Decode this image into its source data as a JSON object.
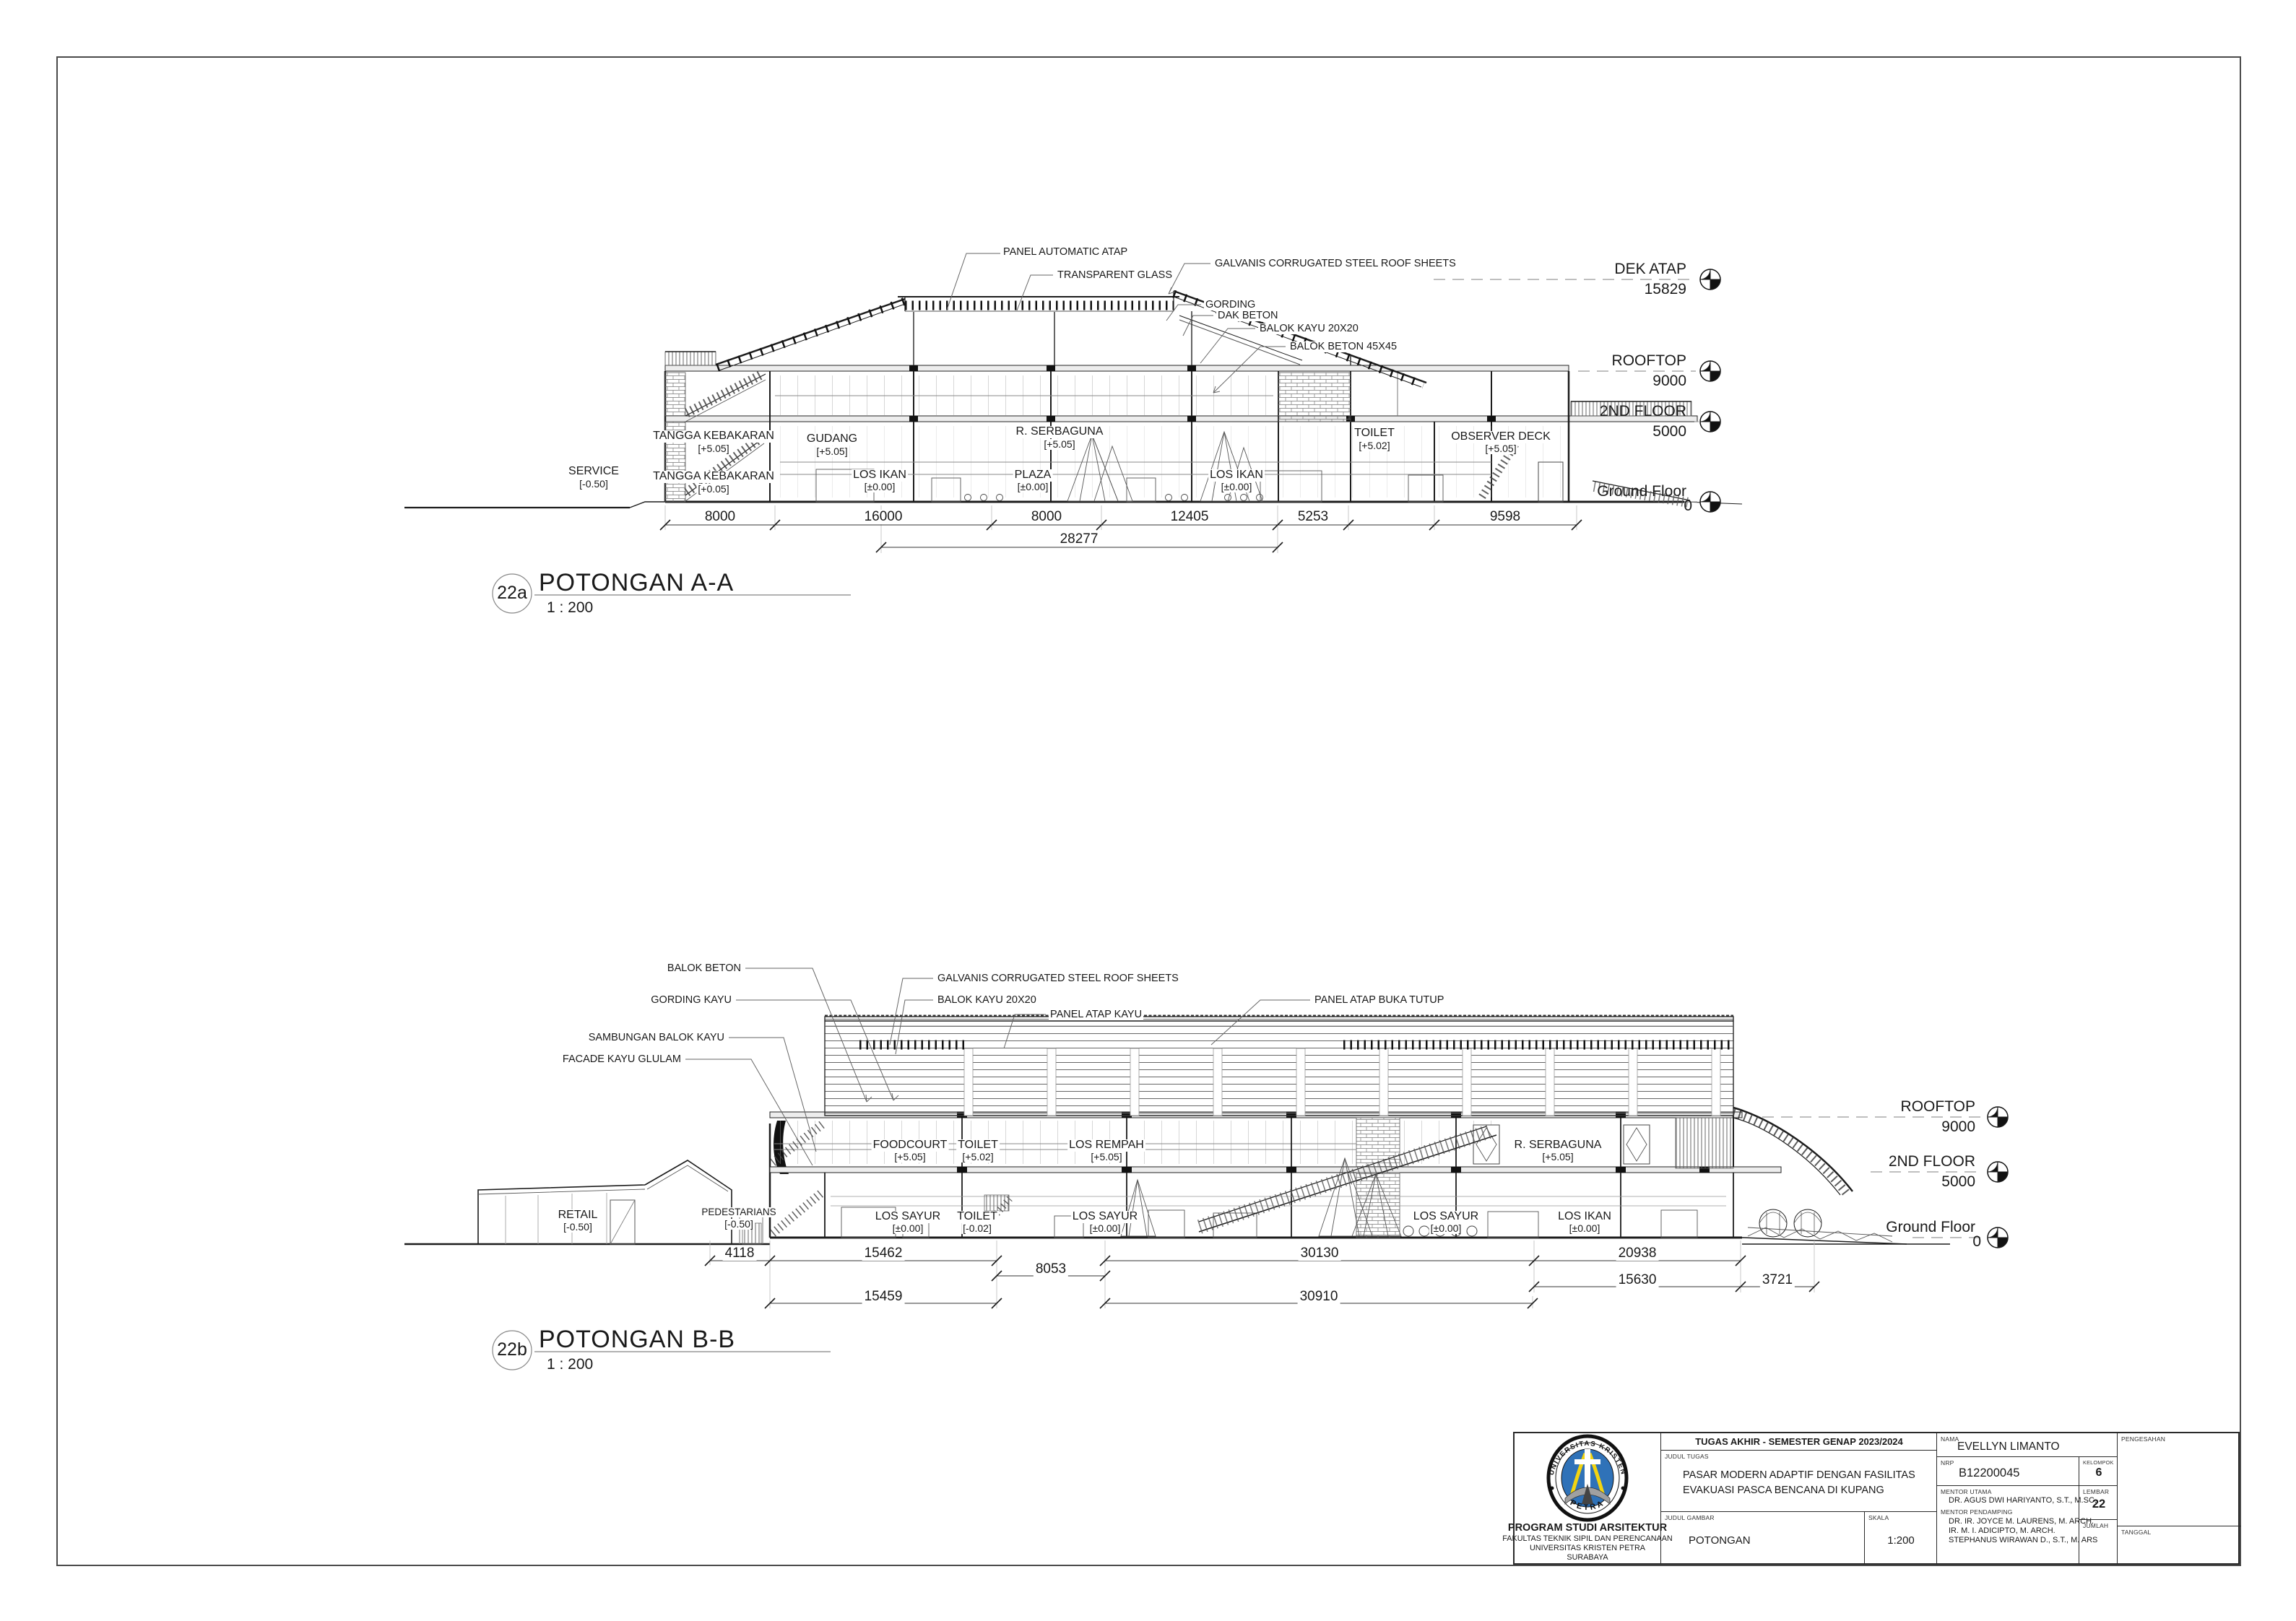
{
  "potongan_aa": {
    "marker_id": "22a",
    "title": "POTONGAN A-A",
    "scale": "1 : 200",
    "callouts": [
      "PANEL AUTOMATIC ATAP",
      "TRANSPARENT GLASS",
      "GALVANIS CORRUGATED STEEL ROOF SHEETS",
      "GORDING",
      "DAK BETON",
      "BALOK KAYU 20X20",
      "BALOK BETON 45X45"
    ],
    "rooms": [
      {
        "name": "TANGGA KEBAKARAN",
        "level": "[+5.05]"
      },
      {
        "name": "GUDANG",
        "level": "[+5.05]"
      },
      {
        "name": "R. SERBAGUNA",
        "level": "[+5.05]"
      },
      {
        "name": "TOILET",
        "level": "[+5.02]"
      },
      {
        "name": "OBSERVER DECK",
        "level": "[+5.05]"
      },
      {
        "name": "TANGGA KEBAKARAN",
        "level": "[+0.05]"
      },
      {
        "name": "LOS IKAN",
        "level": "[±0.00]"
      },
      {
        "name": "PLAZA",
        "level": "[±0.00]"
      },
      {
        "name": "LOS IKAN",
        "level": "[±0.00]"
      },
      {
        "name": "SERVICE",
        "level": "[-0.50]"
      }
    ],
    "levels": [
      {
        "name": "DEK ATAP",
        "value": "15829"
      },
      {
        "name": "ROOFTOP",
        "value": "9000"
      },
      {
        "name": "2ND FLOOR",
        "value": "5000"
      },
      {
        "name": "Ground Floor",
        "value": "0"
      }
    ],
    "dims": [
      "8000",
      "16000",
      "8000",
      "12405",
      "5253",
      "9598"
    ],
    "dim_total": "28277"
  },
  "potongan_bb": {
    "marker_id": "22b",
    "title": "POTONGAN B-B",
    "scale": "1 : 200",
    "callouts": [
      "BALOK BETON",
      "GALVANIS CORRUGATED STEEL ROOF SHEETS",
      "GORDING KAYU",
      "BALOK KAYU 20X20",
      "PANEL ATAP KAYU",
      "PANEL ATAP BUKA TUTUP",
      "SAMBUNGAN BALOK KAYU",
      "FACADE KAYU GLULAM"
    ],
    "rooms_upper": [
      {
        "name": "FOODCOURT",
        "level": "[+5.05]"
      },
      {
        "name": "TOILET",
        "level": "[+5.02]"
      },
      {
        "name": "LOS REMPAH",
        "level": "[+5.05]"
      },
      {
        "name": "R. SERBAGUNA",
        "level": "[+5.05]"
      }
    ],
    "rooms_ground": [
      {
        "name": "RETAIL",
        "level": "[-0.50]"
      },
      {
        "name": "PEDESTARIANS",
        "level": "[-0.50]"
      },
      {
        "name": "LOS SAYUR",
        "level": "[±0.00]"
      },
      {
        "name": "TOILET",
        "level": "[-0.02]"
      },
      {
        "name": "LOS SAYUR",
        "level": "[±0.00]"
      },
      {
        "name": "LOS SAYUR",
        "level": "[±0.00]"
      },
      {
        "name": "LOS IKAN",
        "level": "[±0.00]"
      }
    ],
    "levels": [
      {
        "name": "ROOFTOP",
        "value": "9000"
      },
      {
        "name": "2ND FLOOR",
        "value": "5000"
      },
      {
        "name": "Ground Floor",
        "value": "0"
      }
    ],
    "dims_row1": [
      "4118",
      "15462",
      "8053",
      "30130",
      "20938"
    ],
    "dims_row2": [
      "15459",
      "30910",
      "15630",
      "3721"
    ]
  },
  "title_block": {
    "header": "TUGAS AKHIR - SEMESTER GENAP 2023/2024",
    "labels": {
      "judul_tugas": "JUDUL TUGAS",
      "judul_gambar": "JUDUL GAMBAR",
      "skala": "SKALA",
      "nama": "NAMA",
      "nrp": "NRP",
      "kelompok": "KELOMPOK",
      "mentor_utama": "MENTOR UTAMA",
      "mentor_pendamping": "MENTOR PENDAMPING",
      "lembar": "LEMBAR",
      "jumlah": "JUMLAH",
      "pengesahan": "PENGESAHAN",
      "tanggal": "TANGGAL"
    },
    "judul_tugas_line1": "PASAR MODERN ADAPTIF DENGAN FASILITAS",
    "judul_tugas_line2": "EVAKUASI PASCA BENCANA DI KUPANG",
    "judul_gambar": "POTONGAN",
    "skala": "1:200",
    "nama": "EVELLYN LIMANTO",
    "nrp": "B12200045",
    "kelompok": "6",
    "mentor_utama": "DR. AGUS DWI HARIYANTO, S.T., M.SC.",
    "mentor_pendamping_lines": [
      "DR. IR. JOYCE M. LAURENS, M. ARCH.",
      "IR. M. I. ADICIPTO, M. ARCH.",
      "STEPHANUS WIRAWAN D., S.T., M. ARS"
    ],
    "lembar": "22",
    "institution": {
      "name": "PROGRAM STUDI ARSITEKTUR",
      "faculty": "FAKULTAS TEKNIK SIPIL DAN PERENCANAAN",
      "university": "UNIVERSITAS KRISTEN PETRA",
      "city": "SURABAYA"
    },
    "logo": {
      "arc_text": "UNIVERSITAS KRISTEN",
      "bottom_text": "PETRA",
      "blue": "#2f72b8",
      "yellow": "#f2d411"
    }
  }
}
